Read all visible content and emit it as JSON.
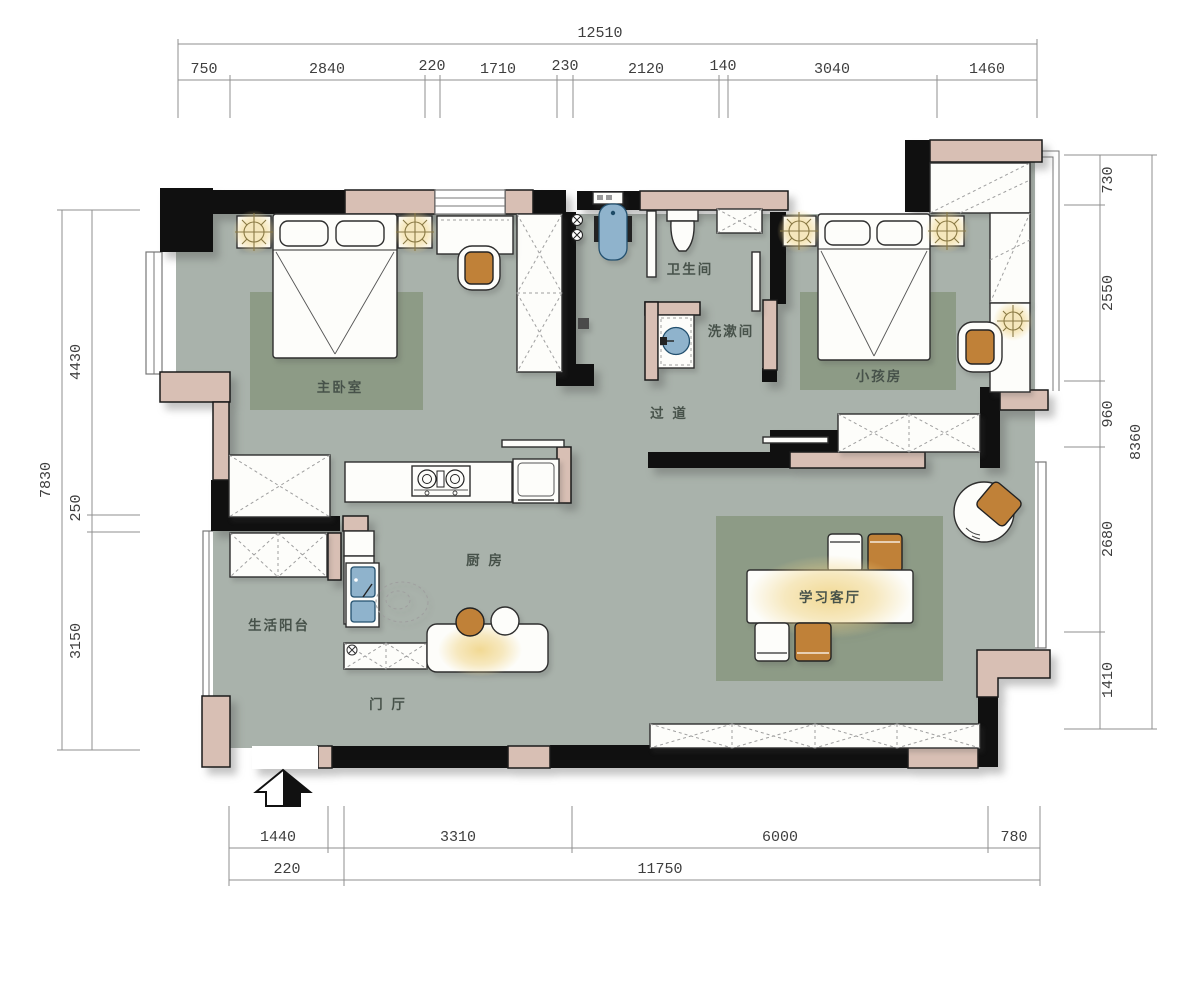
{
  "rooms": {
    "master": "主卧室",
    "bathroom": "卫生间",
    "washroom": "洗漱间",
    "kids": "小孩房",
    "corridor": "过 道",
    "kitchen": "厨 房",
    "living": "学习客厅",
    "balcony": "生活阳台",
    "foyer": "门 厅"
  },
  "dims": {
    "top": {
      "total": "12510",
      "segments": [
        "750",
        "2840",
        "220",
        "1710",
        "230",
        "2120",
        "140",
        "3040",
        "1460"
      ]
    },
    "left": {
      "total": "7830",
      "segments": [
        "4430",
        "250",
        "3150"
      ]
    },
    "right": {
      "total": "8360",
      "segments": [
        "730",
        "2550",
        "960",
        "2680",
        "1410"
      ]
    },
    "bottom": {
      "upper": [
        "1440",
        "3310",
        "6000",
        "780"
      ],
      "lower": [
        "220",
        "11750"
      ]
    }
  },
  "colors": {
    "floor": "#a9b2ab",
    "rug": "#8d9b86",
    "wall_fill": "#d8bfb4",
    "wall": "#101010",
    "accent_orange": "#c08138",
    "fixture_blue": "#8fb3cc",
    "glow_yellow": "#f1d78e"
  }
}
